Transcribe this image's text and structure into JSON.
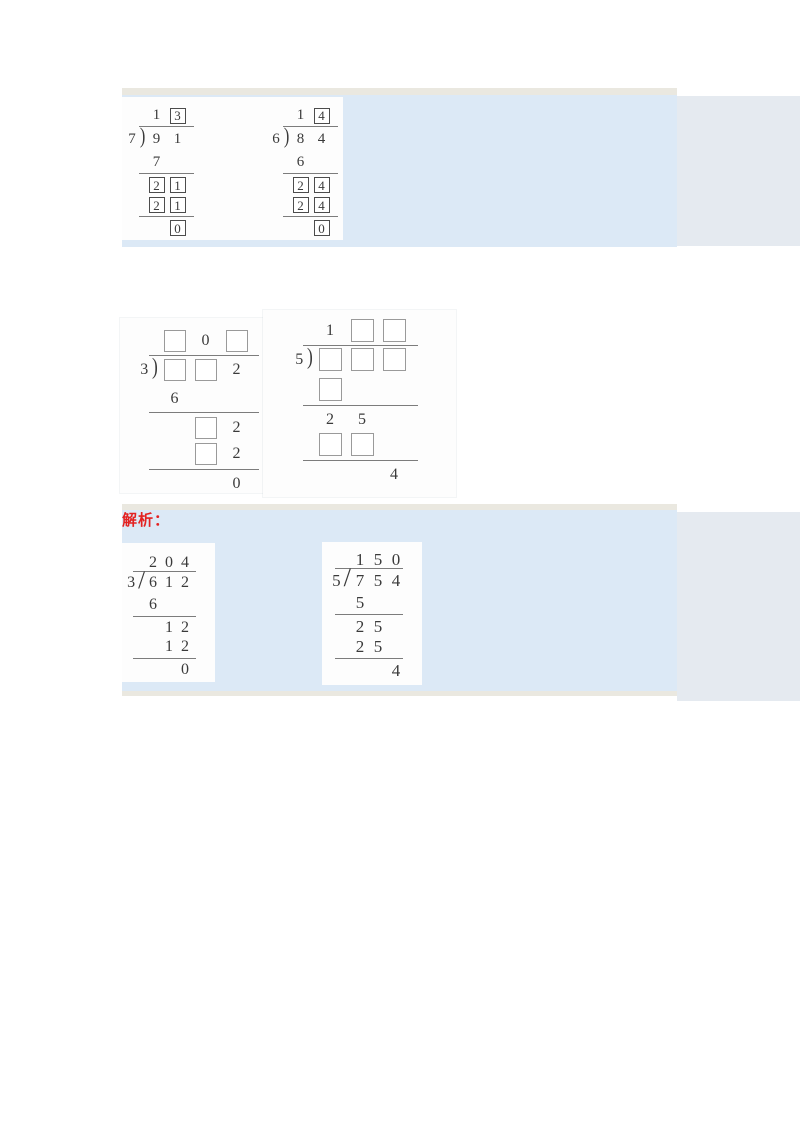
{
  "analysis_label": "解析：",
  "colors": {
    "band_blue": "#dce9f6",
    "band_edge": "#eae8e0",
    "side_strip": "#e5eaf0",
    "accent_red": "#e32222",
    "digit_ink": "#3a3a3a"
  },
  "divisions": [
    {
      "label": "91 divided by 7 equals 13",
      "divisor": "7",
      "bracket": "paren",
      "quotient": [
        {
          "t": "1"
        },
        {
          "t": "3",
          "box": true
        }
      ],
      "dividend": [
        {
          "t": "9"
        },
        {
          "t": "1"
        }
      ],
      "steps": [
        {
          "cells": [
            {
              "t": "7"
            }
          ],
          "offset": 0,
          "line": true
        },
        {
          "cells": [
            {
              "t": "2",
              "box": true
            },
            {
              "t": "1",
              "box": true
            }
          ],
          "offset": 0
        },
        {
          "cells": [
            {
              "t": "2",
              "box": true
            },
            {
              "t": "1",
              "box": true
            }
          ],
          "offset": 0,
          "line": true
        },
        {
          "cells": [
            {
              "t": "0",
              "box": true
            }
          ],
          "offset": 1
        }
      ]
    },
    {
      "label": "84 divided by 6 equals 14",
      "divisor": "6",
      "bracket": "paren",
      "quotient": [
        {
          "t": "1"
        },
        {
          "t": "4",
          "box": true
        }
      ],
      "dividend": [
        {
          "t": "8"
        },
        {
          "t": "4"
        }
      ],
      "steps": [
        {
          "cells": [
            {
              "t": "6"
            }
          ],
          "offset": 0,
          "line": true
        },
        {
          "cells": [
            {
              "t": "2",
              "box": true
            },
            {
              "t": "4",
              "box": true
            }
          ],
          "offset": 0
        },
        {
          "cells": [
            {
              "t": "2",
              "box": true
            },
            {
              "t": "4",
              "box": true
            }
          ],
          "offset": 0,
          "line": true
        },
        {
          "cells": [
            {
              "t": "0",
              "box": true
            }
          ],
          "offset": 1
        }
      ]
    },
    {
      "label": "fill-in division by 3, quotient blank 0 blank, dividend blank blank 2",
      "divisor": "3",
      "bracket": "paren",
      "quotient": [
        {
          "box": true
        },
        {
          "t": "0"
        },
        {
          "box": true
        }
      ],
      "dividend": [
        {
          "box": true
        },
        {
          "box": true
        },
        {
          "t": "2"
        }
      ],
      "steps": [
        {
          "cells": [
            {
              "t": "6"
            }
          ],
          "offset": 0,
          "line": true
        },
        {
          "cells": [
            {
              "box": true
            },
            {
              "t": "2"
            }
          ],
          "offset": 1
        },
        {
          "cells": [
            {
              "box": true
            },
            {
              "t": "2"
            }
          ],
          "offset": 1,
          "line": true
        },
        {
          "cells": [
            {
              "t": "0"
            }
          ],
          "offset": 2
        }
      ]
    },
    {
      "label": "fill-in division by 5, quotient 1 blank blank, remainder 4",
      "divisor": "5",
      "bracket": "paren",
      "quotient": [
        {
          "t": "1"
        },
        {
          "box": true
        },
        {
          "box": true
        }
      ],
      "dividend": [
        {
          "box": true
        },
        {
          "box": true
        },
        {
          "box": true
        }
      ],
      "steps": [
        {
          "cells": [
            {
              "box": true
            }
          ],
          "offset": 0,
          "line": true
        },
        {
          "cells": [
            {
              "t": "2"
            },
            {
              "t": "5"
            }
          ],
          "offset": 0
        },
        {
          "cells": [
            {
              "box": true
            },
            {
              "box": true
            }
          ],
          "offset": 0,
          "line": true
        },
        {
          "cells": [
            {
              "t": "4"
            }
          ],
          "offset": 2
        }
      ]
    },
    {
      "label": "612 divided by 3 equals 204",
      "divisor": "3",
      "bracket": "slash",
      "quotient": [
        {
          "t": "2"
        },
        {
          "t": "0"
        },
        {
          "t": "4"
        }
      ],
      "dividend": [
        {
          "t": "6"
        },
        {
          "t": "1"
        },
        {
          "t": "2"
        }
      ],
      "steps": [
        {
          "cells": [
            {
              "t": "6"
            }
          ],
          "offset": 0,
          "line": true
        },
        {
          "cells": [
            {
              "t": "1"
            },
            {
              "t": "2"
            }
          ],
          "offset": 1
        },
        {
          "cells": [
            {
              "t": "1"
            },
            {
              "t": "2"
            }
          ],
          "offset": 1,
          "line": true
        },
        {
          "cells": [
            {
              "t": "0"
            }
          ],
          "offset": 2
        }
      ]
    },
    {
      "label": "754 divided by 5 equals 150 remainder 4",
      "divisor": "5",
      "bracket": "slash",
      "quotient": [
        {
          "t": "1"
        },
        {
          "t": "5"
        },
        {
          "t": "0"
        }
      ],
      "dividend": [
        {
          "t": "7"
        },
        {
          "t": "5"
        },
        {
          "t": "4"
        }
      ],
      "steps": [
        {
          "cells": [
            {
              "t": "5"
            }
          ],
          "offset": 0,
          "line": true
        },
        {
          "cells": [
            {
              "t": "2"
            },
            {
              "t": "5"
            }
          ],
          "offset": 0
        },
        {
          "cells": [
            {
              "t": "2"
            },
            {
              "t": "5"
            }
          ],
          "offset": 0,
          "line": true
        },
        {
          "cells": [
            {
              "t": "4"
            }
          ],
          "offset": 2
        }
      ]
    }
  ]
}
